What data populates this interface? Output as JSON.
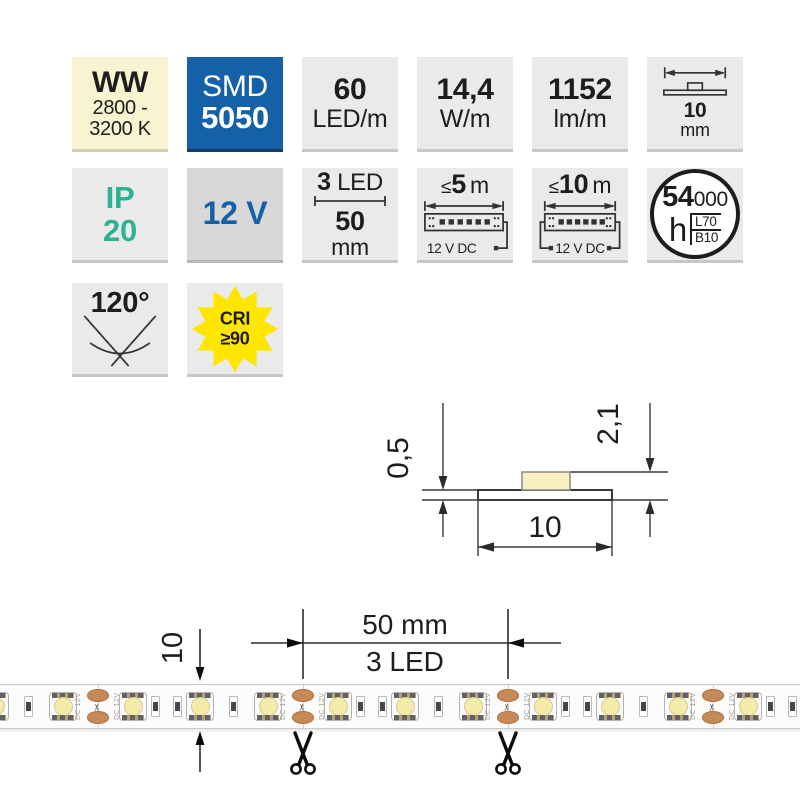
{
  "colors": {
    "accent_blue": "#1561a8",
    "teal": "#2bb394",
    "cream": "#f8f3d0",
    "star_yellow": "#ffe600",
    "copper_pad": "#c68a59",
    "tile_gray": "#eaeaea"
  },
  "badges": {
    "cct": {
      "title": "WW",
      "range_line1": "2800 -",
      "range_line2": "3200 K"
    },
    "chip": {
      "type": "SMD",
      "model": "5050"
    },
    "density": {
      "value": "60",
      "unit": "LED/m"
    },
    "power": {
      "value": "14,4",
      "unit": "W/m"
    },
    "flux": {
      "value": "1152",
      "unit": "lm/m"
    },
    "strip_width": {
      "value": "10",
      "unit": "mm"
    },
    "ip_rating": {
      "code": "IP",
      "value": "20"
    },
    "voltage": {
      "label": "12 V"
    },
    "cut_module": {
      "led_count": "3",
      "led_unit": "LED",
      "length": "50",
      "length_unit": "mm"
    },
    "max_run_single_feed": {
      "sign": "≤",
      "value": "5",
      "unit": "m",
      "supply": "12 V DC"
    },
    "max_run_dual_feed": {
      "sign": "≤",
      "value": "10",
      "unit": "m",
      "supply": "12 V DC"
    },
    "lifetime": {
      "value": "54",
      "zeros": "000",
      "unit": "h",
      "lumen_maintenance": "L70",
      "failure_rate": "B10"
    },
    "beam_angle": {
      "value": "120°"
    },
    "cri": {
      "label": "CRI",
      "value": "≥90"
    }
  },
  "cross_section": {
    "pcb_thickness": "0,5",
    "overall_height": "2,1",
    "width": "10"
  },
  "strip_figure": {
    "width_label": "10",
    "module_length_label": "50 mm",
    "module_led_label": "3 LED",
    "pad_label": "DC 12V",
    "scissors_glyph": "✂"
  },
  "strip_layout": {
    "cuts": [
      -107,
      98,
      303,
      508,
      713
    ],
    "led_offsets": [
      35,
      102,
      170
    ],
    "part_pair_offsets": [
      57,
      79
    ],
    "part_single_offset": 135
  }
}
